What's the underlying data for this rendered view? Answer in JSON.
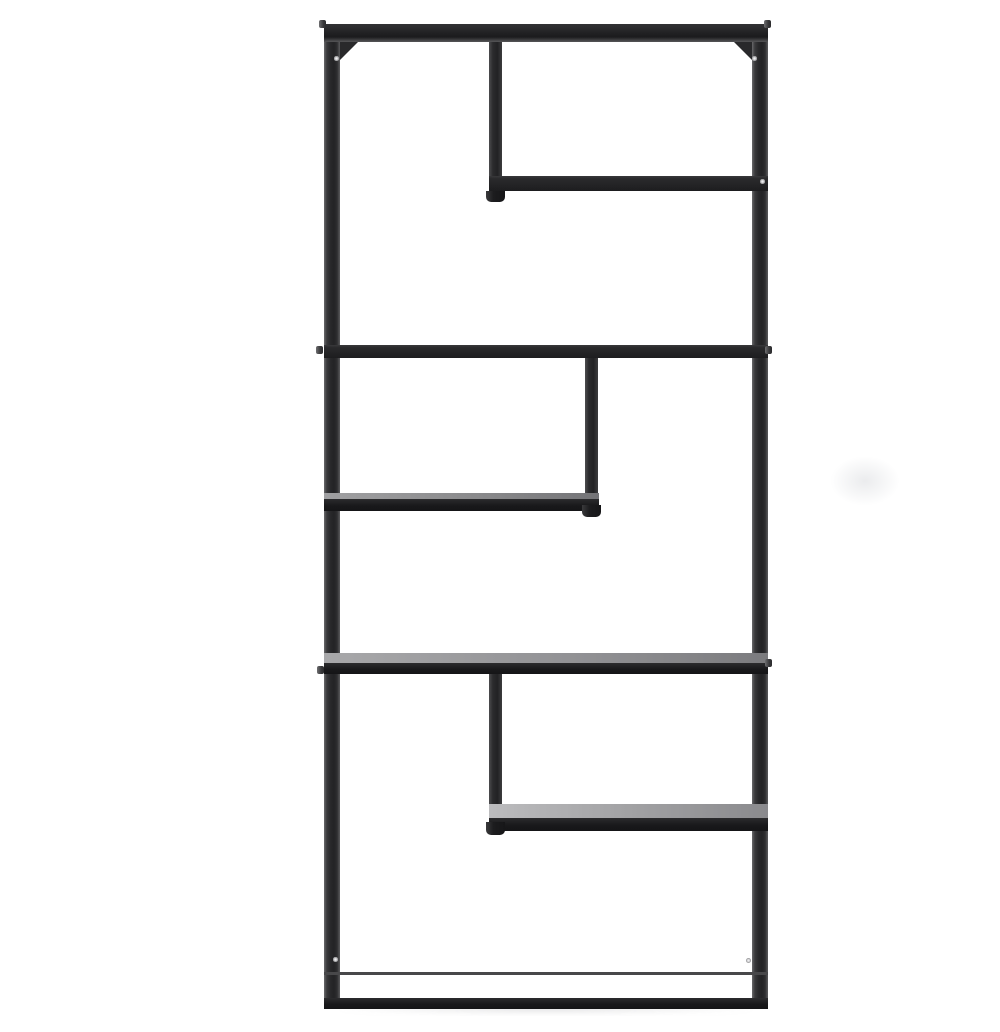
{
  "scene": {
    "subject": "Black metal geometric open-back etagere bookcase, front product view on white background",
    "background_color": "#ffffff",
    "frame_color": "#232325",
    "frame_highlight_color": "#69696b",
    "shelf_front_color": "#19191b",
    "shelf_surface_light": "#bcbcbe",
    "shelf_surface_dark": "#6b6b6e",
    "hardware_screw_color": "#efeff1",
    "tier_count": 6,
    "parts": {
      "outer_frame": "rectangular tube-steel frame, two tall side posts with top rail and bottom shelf",
      "upper_right_shelf": "partial shelf under short divider, right half near top",
      "full_shelf_upper": "full-width shelf at upper third",
      "middle_left_shelf": "partial shelf on left half with short divider above",
      "full_shelf_lower": "full-width shelf at lower third",
      "lower_right_shelf": "partial shelf on right half with short divider above",
      "bottom_shelf": "full-width base shelf"
    }
  }
}
